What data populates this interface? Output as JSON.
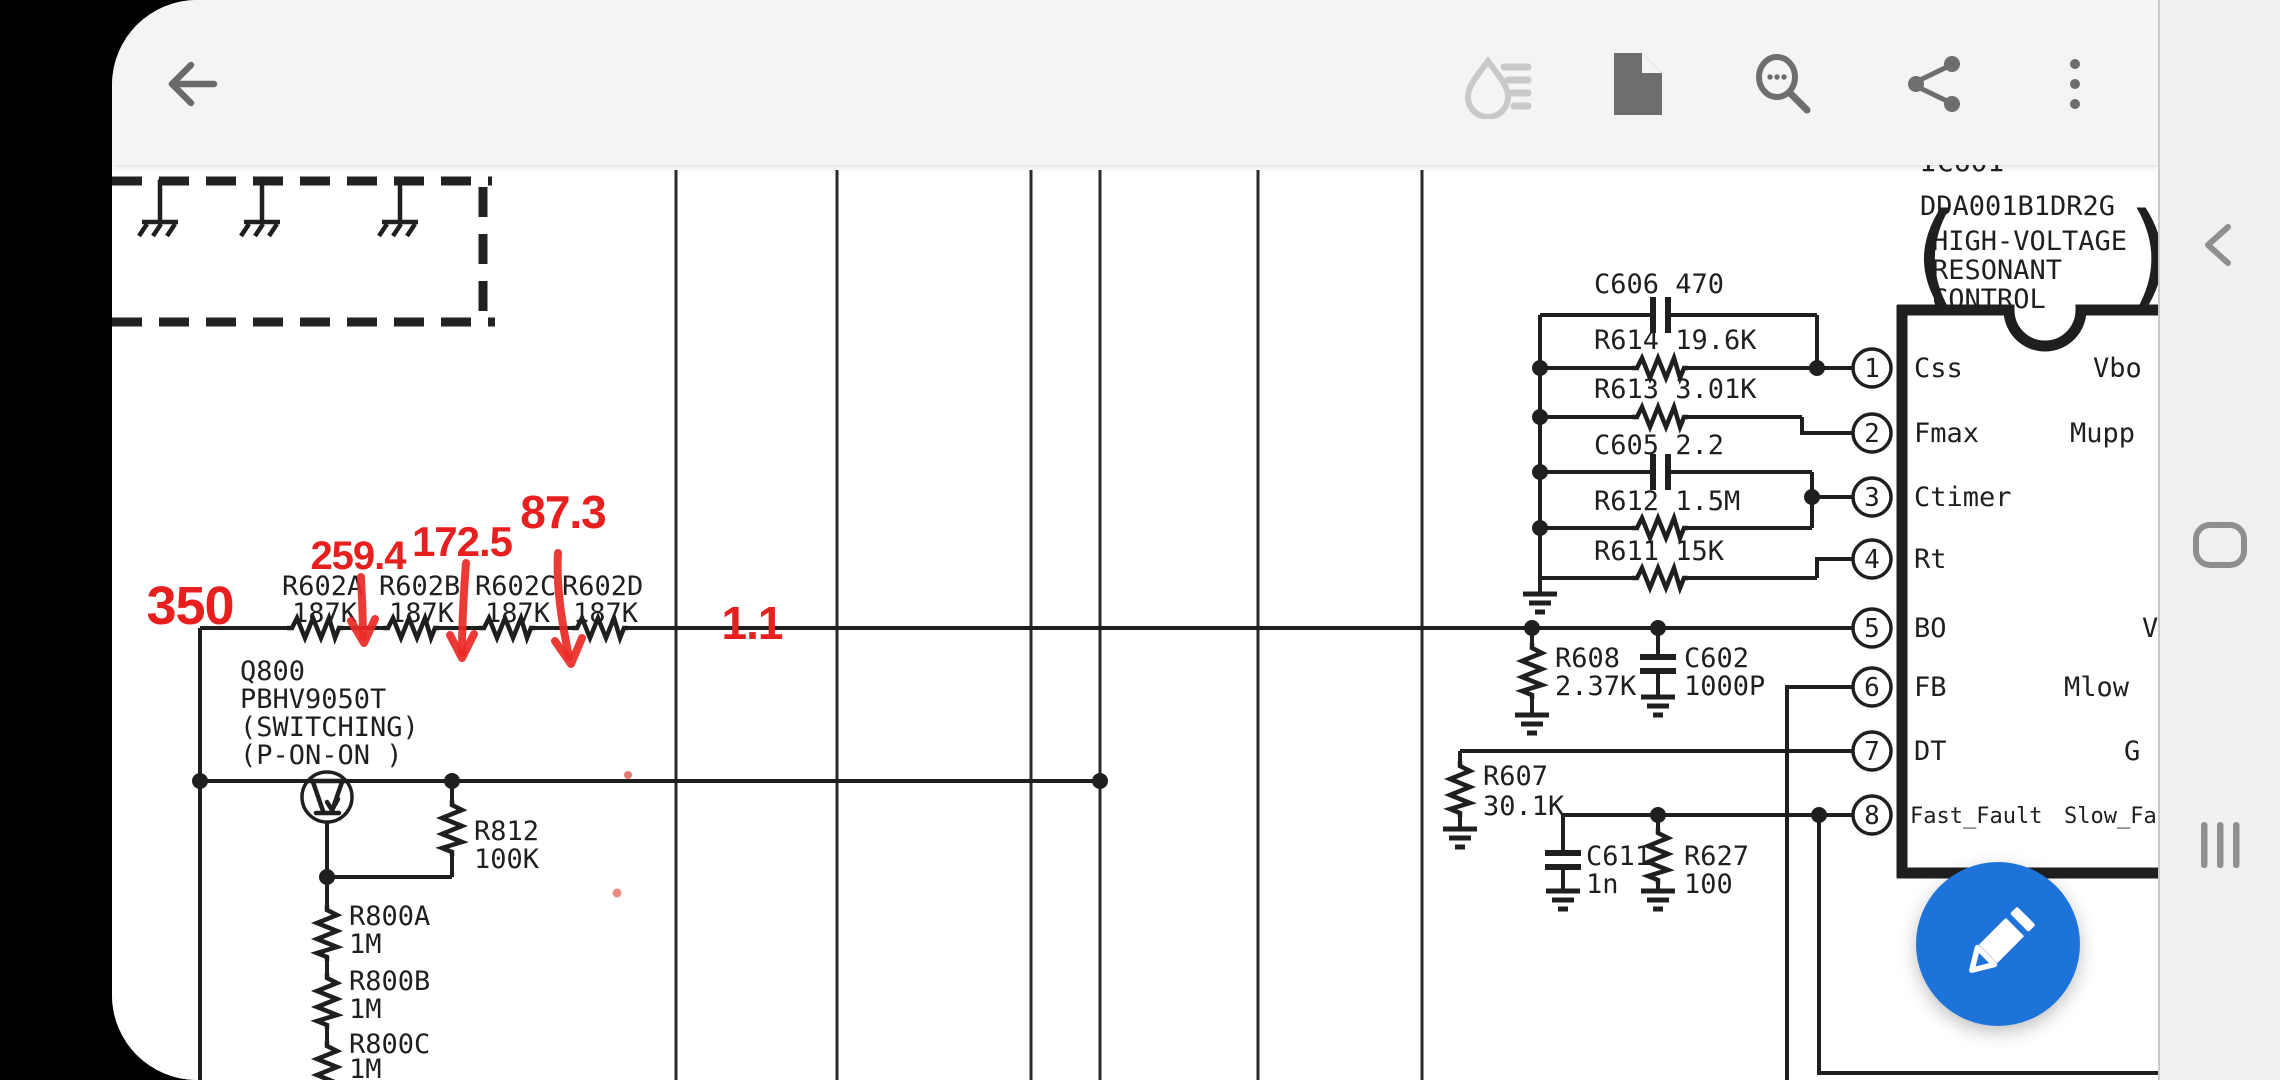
{
  "app": {
    "accent_blue": "#1e73db",
    "annotation_red": "#e81f1f",
    "toolbar_bg": "#f4f4f5",
    "ink": "#1f1f1f"
  },
  "toolbar": {
    "back_icon": "back-arrow",
    "ink_icon": "ink-annotation-visibility",
    "document_icon": "document-page",
    "search_icon": "search-with-options",
    "share_icon": "share",
    "overflow_icon": "more-vertical"
  },
  "nav": {
    "back": "back",
    "home": "home",
    "recents": "recents"
  },
  "fab": {
    "icon": "pencil-edit"
  },
  "schematic": {
    "red_marks": {
      "v350": "350",
      "v259": "259.4",
      "v172": "172.5",
      "v87": "87.3",
      "v11": "1.1"
    },
    "r602": {
      "names": [
        "R602A",
        "R602B",
        "R602C",
        "R602D"
      ],
      "values": [
        "187K",
        "187K",
        "187K",
        "187K"
      ]
    },
    "q800": {
      "lines": [
        "Q800",
        "PBHV9050T",
        "(SWITCHING)",
        "(P-ON-ON )"
      ]
    },
    "r812": {
      "name": "R812",
      "value": "100K"
    },
    "r800": [
      {
        "name": "R800A",
        "value": "1M"
      },
      {
        "name": "R800B",
        "value": "1M"
      },
      {
        "name": "R800C",
        "value": "1M"
      }
    ],
    "network": [
      {
        "label": "C606 470"
      },
      {
        "label": "R614 19.6K"
      },
      {
        "label": "R613 3.01K"
      },
      {
        "label": "C605 2.2"
      },
      {
        "label": "R612 1.5M"
      },
      {
        "label": "R611 15K"
      }
    ],
    "r608": {
      "name": "R608",
      "value": "2.37K"
    },
    "c602": {
      "name": "C602",
      "value": "1000P"
    },
    "r607": {
      "name": "R607",
      "value": "30.1K"
    },
    "c611": {
      "name": "C611",
      "value": "1n"
    },
    "r627": {
      "name": "R627",
      "value": "100"
    },
    "ic": {
      "ref": "IC601",
      "part": "DDA001B1DR2G",
      "desc": [
        "HIGH-VOLTAGE",
        "RESONANT",
        "CONTROL"
      ],
      "paren_open": "(",
      "paren_close": ")",
      "pins": [
        {
          "num": "1",
          "name": "Css",
          "right": "Vbo"
        },
        {
          "num": "2",
          "name": "Fmax",
          "right": "Mupp"
        },
        {
          "num": "3",
          "name": "Ctimer",
          "right": ""
        },
        {
          "num": "4",
          "name": "Rt",
          "right": ""
        },
        {
          "num": "5",
          "name": "BO",
          "right": "V"
        },
        {
          "num": "6",
          "name": "FB",
          "right": "Mlow"
        },
        {
          "num": "7",
          "name": "DT",
          "right": "G"
        },
        {
          "num": "8",
          "name": "Fast_Fault",
          "right": "Slow_Fa"
        }
      ]
    }
  }
}
